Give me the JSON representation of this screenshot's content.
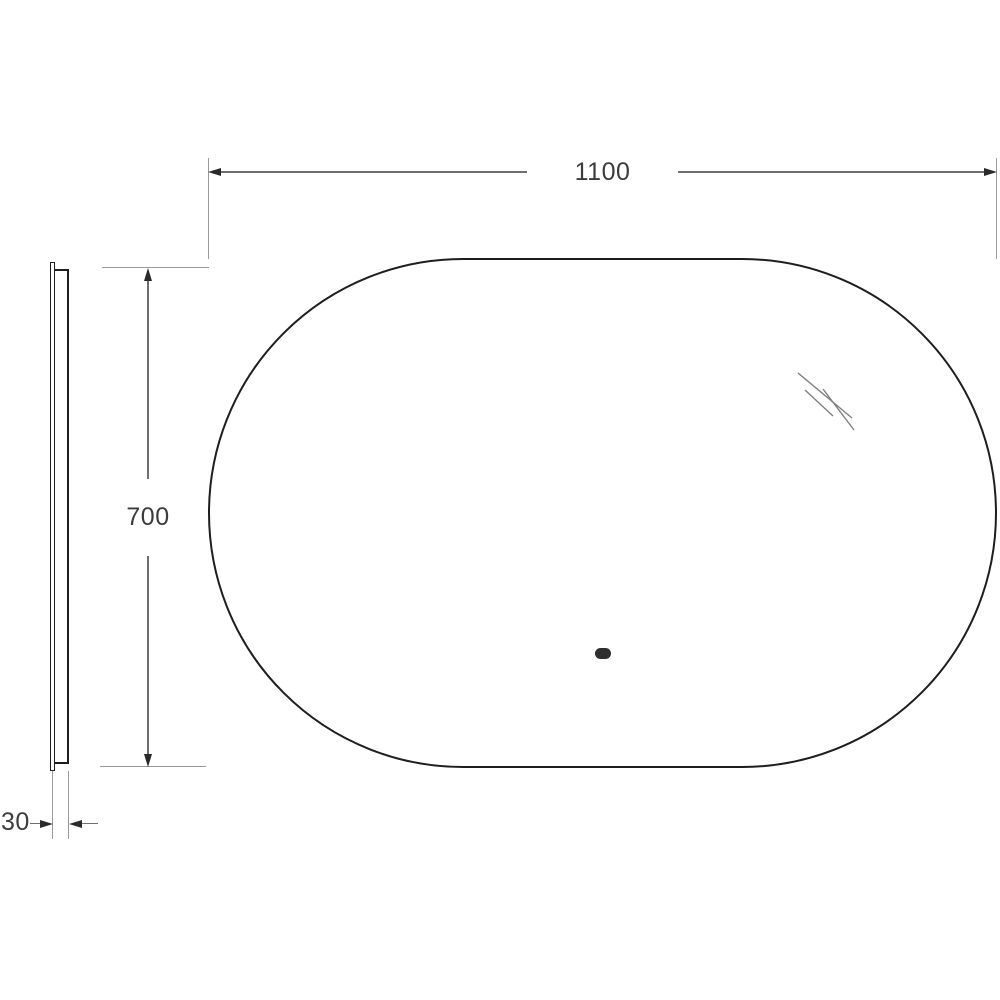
{
  "diagram": {
    "subject": "oval-mirror-technical-dimension-drawing",
    "views": {
      "front": {
        "shape": "stadium-oval",
        "features": [
          "shine-marks",
          "touch-sensor-dot"
        ]
      },
      "side": {
        "shape": "thin-edge-profile"
      }
    },
    "dims": {
      "width": "1100",
      "height": "700",
      "depth": "30"
    },
    "colors": {
      "background": "#ffffff",
      "outline": "#1e1e1e",
      "dimension_line": "#6f6f6f",
      "extension_line": "#9a9a9a",
      "arrow": "#2a2a2a",
      "label_text": "#3c3c3c",
      "sensor": "#2e2e2e",
      "shine": "#808080"
    }
  }
}
